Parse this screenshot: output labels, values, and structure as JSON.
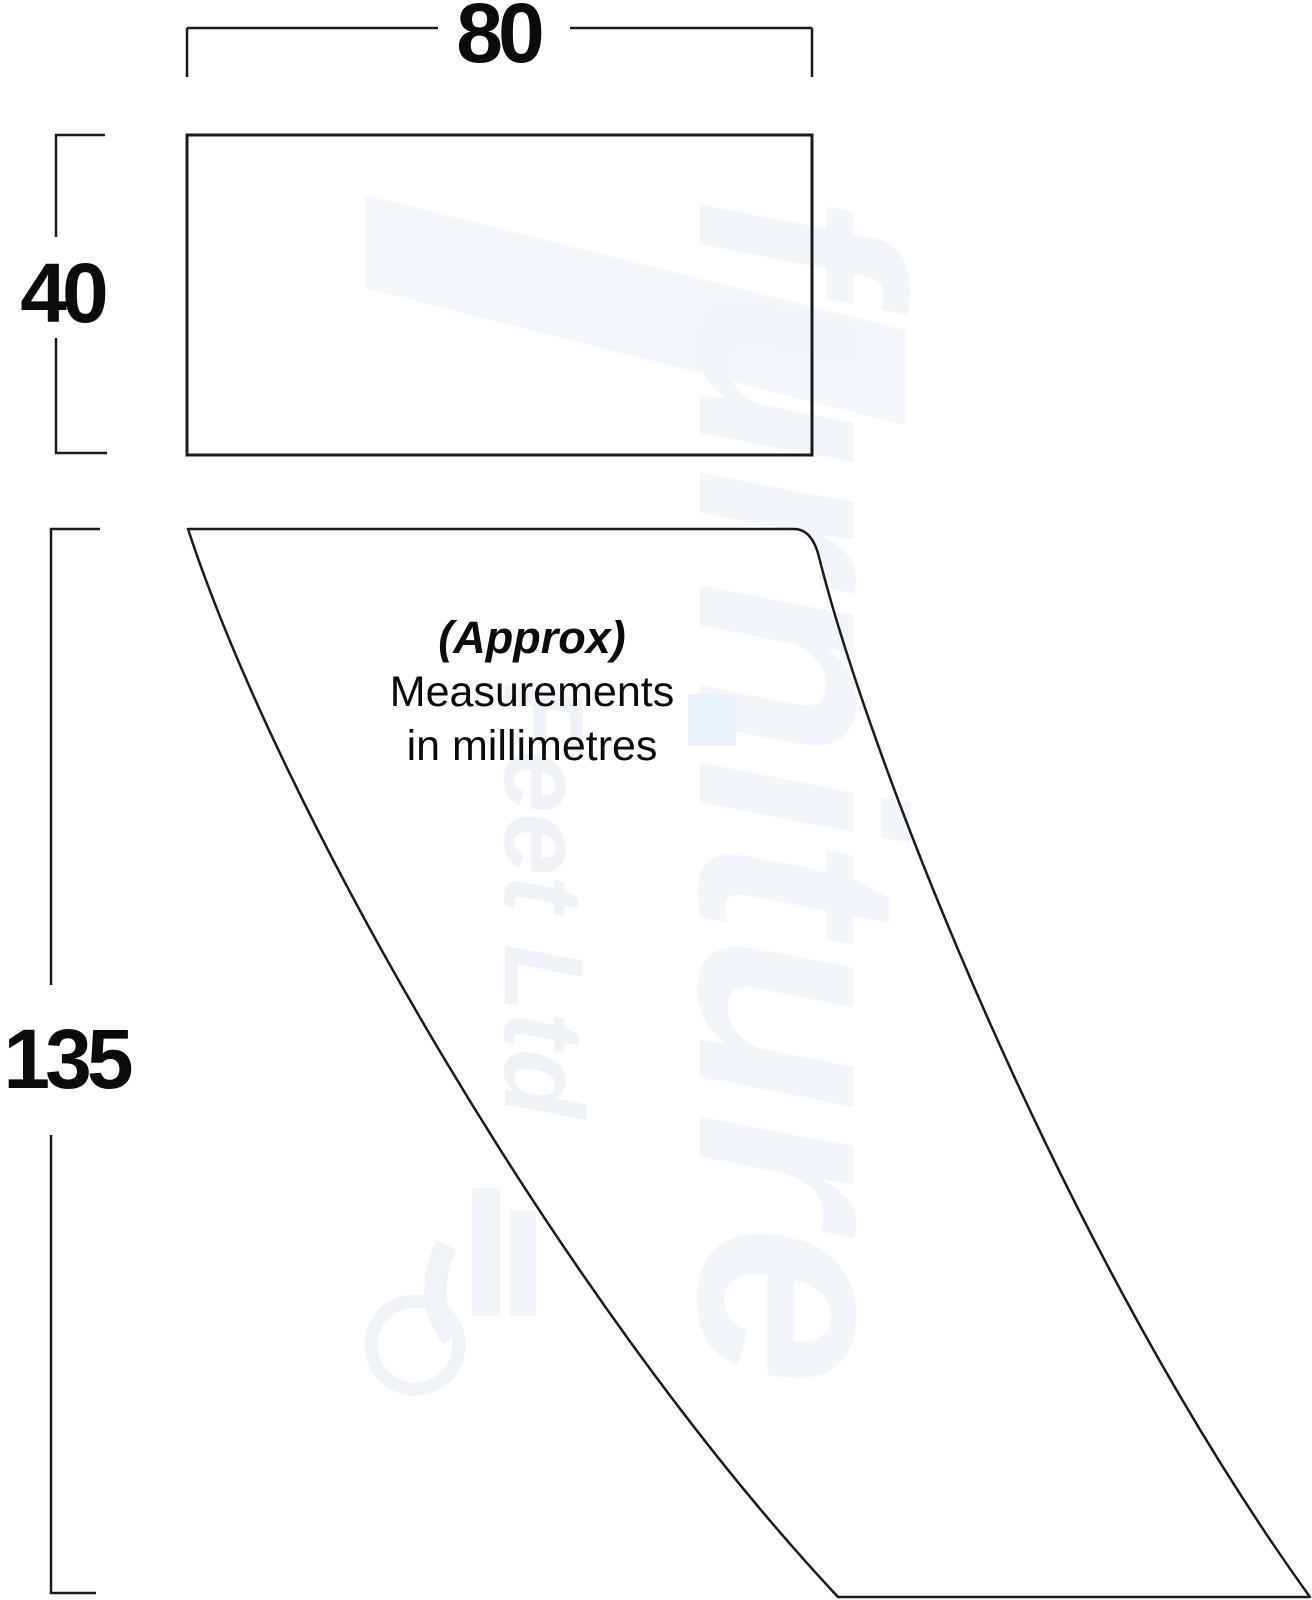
{
  "dimensions": {
    "width_mm": "80",
    "depth_mm": "40",
    "height_mm": "135"
  },
  "note": {
    "line1": "(Approx)",
    "line2": "Measurements",
    "line3": "in millimetres"
  },
  "watermark": {
    "brand": "furniture",
    "suffix": "Feet Ltd"
  },
  "colors": {
    "line": "#1a1a1a",
    "text": "#0b0b0b",
    "watermark": "#f2f5f9",
    "background": "#ffffff"
  }
}
